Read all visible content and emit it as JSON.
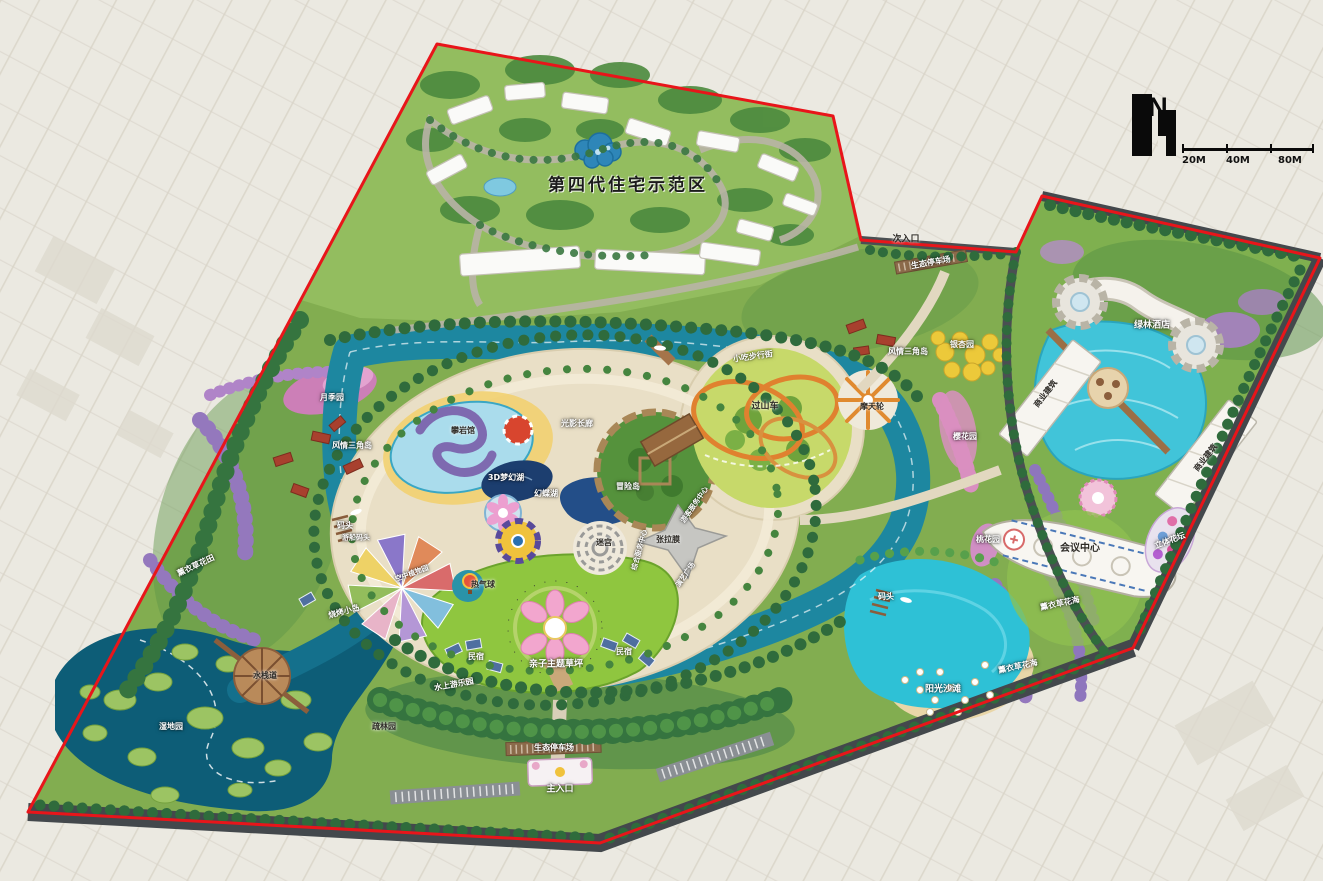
{
  "map": {
    "title": "第四代住宅示范区",
    "north_label": "N",
    "scale": {
      "t1": "20M",
      "t2": "40M",
      "t3": "80M"
    },
    "palette": {
      "boundary_red": "#e8151a",
      "park_green": "#82ad50",
      "forest_green": "#3f7d45",
      "river_teal": "#1d87a0",
      "wetland_teal": "#0d5d77",
      "lagoon_cyan": "#2ec1d6",
      "beach_sand": "#e9d6a8",
      "plaza_cream": "#e9dfc6",
      "lawn_green": "#8fc63f",
      "road_dark": "#43484c",
      "lavender_purple": "#9478bd",
      "farmland_bg": "#ebe9e1"
    },
    "labels": [
      {
        "t": "次入口",
        "x": 906,
        "y": 240,
        "c": "dark",
        "s": 9
      },
      {
        "t": "生态停车场",
        "x": 931,
        "y": 263,
        "c": "light",
        "s": 8,
        "r": -10
      },
      {
        "t": "绿林酒店",
        "x": 1152,
        "y": 326,
        "c": "light",
        "s": 9
      },
      {
        "t": "商业建筑",
        "x": 1046,
        "y": 394,
        "c": "dark",
        "s": 8,
        "r": -52
      },
      {
        "t": "商业建筑",
        "x": 1206,
        "y": 458,
        "c": "dark",
        "s": 8,
        "r": -52
      },
      {
        "t": "会议中心",
        "x": 1080,
        "y": 549,
        "c": "dark",
        "s": 10
      },
      {
        "t": "立体花坛",
        "x": 1170,
        "y": 541,
        "c": "light",
        "s": 8,
        "r": -20
      },
      {
        "t": "薰衣草花海",
        "x": 1060,
        "y": 604,
        "c": "light",
        "s": 8,
        "r": -12
      },
      {
        "t": "薰衣草花海",
        "x": 1018,
        "y": 667,
        "c": "light",
        "s": 8,
        "r": -12
      },
      {
        "t": "阳光沙滩",
        "x": 943,
        "y": 690,
        "c": "light",
        "s": 9
      },
      {
        "t": "码头",
        "x": 886,
        "y": 597,
        "c": "light",
        "s": 8
      },
      {
        "t": "码头",
        "x": 345,
        "y": 526,
        "c": "light",
        "s": 8
      },
      {
        "t": "游船码头",
        "x": 356,
        "y": 538,
        "c": "light",
        "s": 7
      },
      {
        "t": "银杏园",
        "x": 962,
        "y": 345,
        "c": "light",
        "s": 8
      },
      {
        "t": "樱花园",
        "x": 965,
        "y": 437,
        "c": "light",
        "s": 8
      },
      {
        "t": "桃花园",
        "x": 988,
        "y": 540,
        "c": "light",
        "s": 8
      },
      {
        "t": "风情三角岛",
        "x": 908,
        "y": 352,
        "c": "light",
        "s": 8
      },
      {
        "t": "风情三角岛",
        "x": 352,
        "y": 446,
        "c": "light",
        "s": 8
      },
      {
        "t": "月季园",
        "x": 332,
        "y": 398,
        "c": "light",
        "s": 8
      },
      {
        "t": "攀岩馆",
        "x": 463,
        "y": 431,
        "c": "dark",
        "s": 8
      },
      {
        "t": "光影长廊",
        "x": 577,
        "y": 424,
        "c": "light",
        "s": 8
      },
      {
        "t": "3D梦幻湖",
        "x": 506,
        "y": 478,
        "c": "light",
        "s": 8
      },
      {
        "t": "幻蝶湖",
        "x": 546,
        "y": 494,
        "c": "light",
        "s": 8
      },
      {
        "t": "冒险岛",
        "x": 628,
        "y": 487,
        "c": "light",
        "s": 8
      },
      {
        "t": "迷宫",
        "x": 604,
        "y": 543,
        "c": "dark",
        "s": 8
      },
      {
        "t": "游客服务中心",
        "x": 695,
        "y": 505,
        "c": "light",
        "s": 7,
        "r": -55
      },
      {
        "t": "综合服务中心",
        "x": 640,
        "y": 550,
        "c": "light",
        "s": 7,
        "r": -75
      },
      {
        "t": "张拉膜",
        "x": 668,
        "y": 540,
        "c": "dark",
        "s": 8
      },
      {
        "t": "演艺广场",
        "x": 686,
        "y": 575,
        "c": "light",
        "s": 7,
        "r": -55
      },
      {
        "t": "热气球",
        "x": 483,
        "y": 585,
        "c": "dark",
        "s": 8
      },
      {
        "t": "空中植物园",
        "x": 412,
        "y": 574,
        "c": "light",
        "s": 7,
        "r": -20
      },
      {
        "t": "烧烤小岛",
        "x": 344,
        "y": 612,
        "c": "light",
        "s": 8,
        "r": -15
      },
      {
        "t": "亲子主题草坪",
        "x": 556,
        "y": 665,
        "c": "light",
        "s": 9
      },
      {
        "t": "民宿",
        "x": 476,
        "y": 657,
        "c": "light",
        "s": 8
      },
      {
        "t": "民宿",
        "x": 624,
        "y": 652,
        "c": "light",
        "s": 8
      },
      {
        "t": "水上游乐园",
        "x": 454,
        "y": 685,
        "c": "light",
        "s": 8,
        "r": -10
      },
      {
        "t": "生态停车场",
        "x": 554,
        "y": 748,
        "c": "light",
        "s": 8
      },
      {
        "t": "主入口",
        "x": 560,
        "y": 790,
        "c": "light",
        "s": 9
      },
      {
        "t": "水栈道",
        "x": 265,
        "y": 676,
        "c": "dark",
        "s": 8
      },
      {
        "t": "湿地园",
        "x": 171,
        "y": 727,
        "c": "light",
        "s": 8
      },
      {
        "t": "疏林园",
        "x": 384,
        "y": 727,
        "c": "dark",
        "s": 8
      },
      {
        "t": "薰衣草花田",
        "x": 196,
        "y": 566,
        "c": "light",
        "s": 8,
        "r": -25
      },
      {
        "t": "小吃步行街",
        "x": 753,
        "y": 357,
        "c": "light",
        "s": 8,
        "r": -8
      },
      {
        "t": "过山车",
        "x": 765,
        "y": 407,
        "c": "dark",
        "s": 9
      },
      {
        "t": "摩天轮",
        "x": 872,
        "y": 407,
        "c": "dark",
        "s": 8
      }
    ]
  }
}
